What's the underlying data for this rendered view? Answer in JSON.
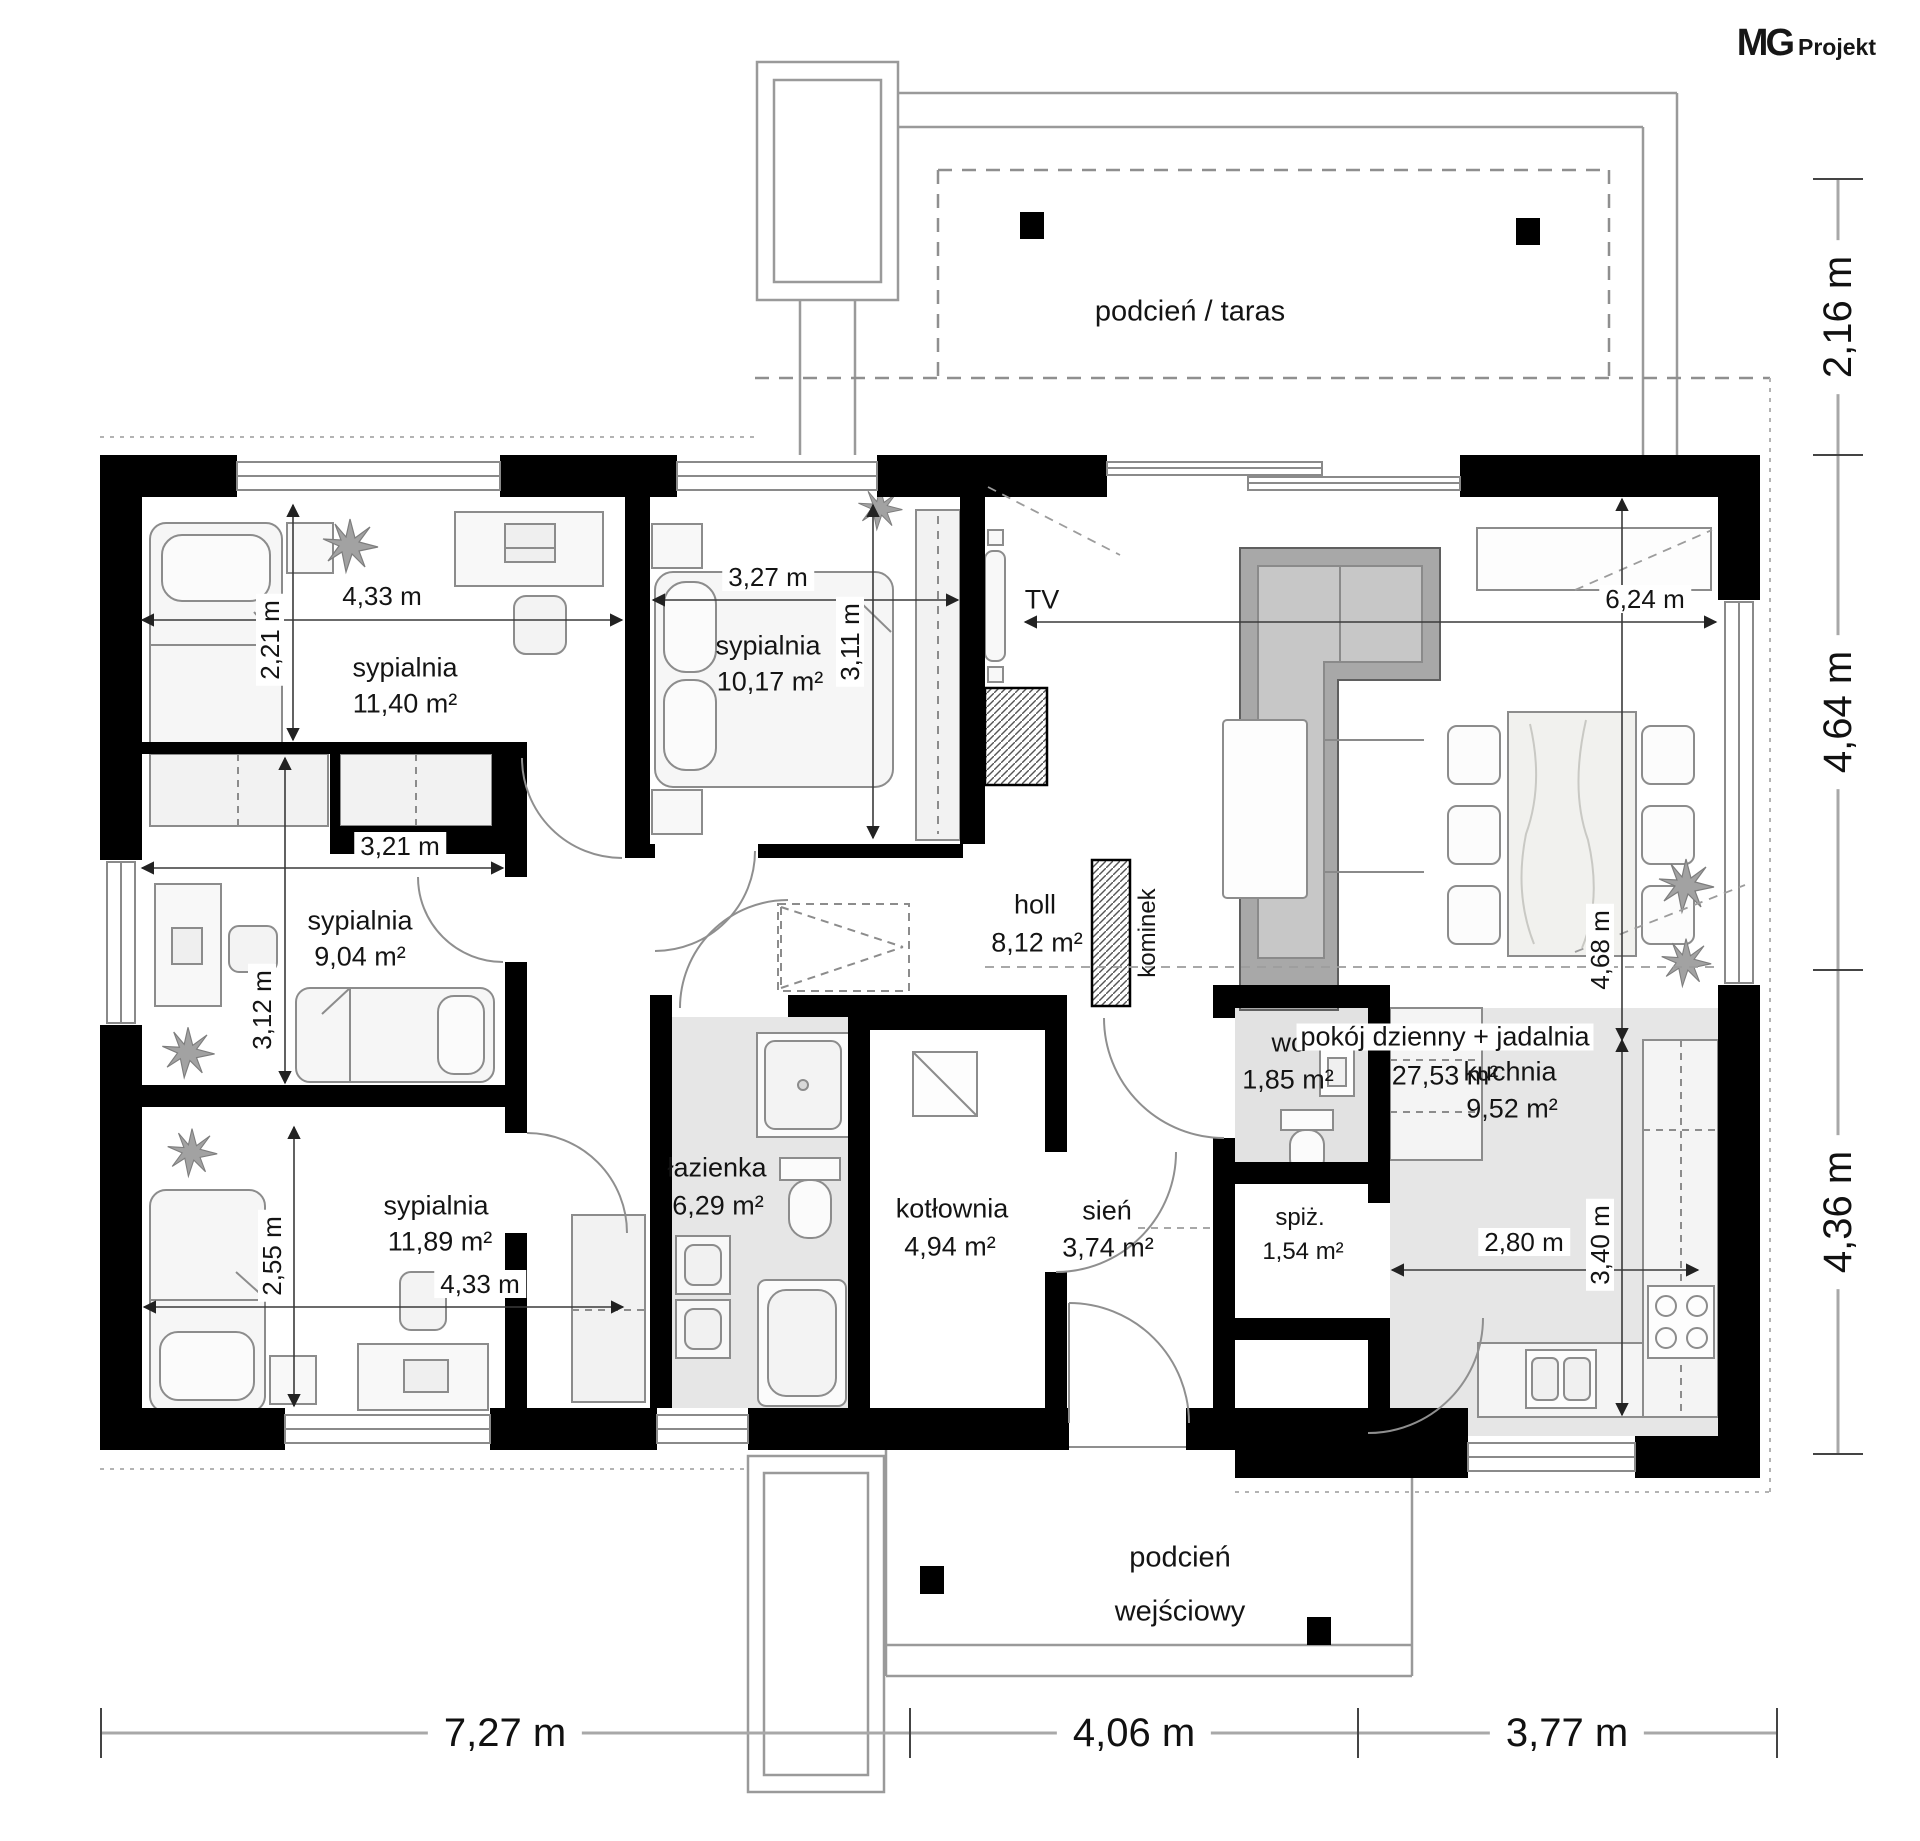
{
  "logo": {
    "brand": "MG",
    "suffix": "Projekt"
  },
  "outdoor": {
    "terrace_label": "podcień / taras",
    "porch_line1": "podcień",
    "porch_line2": "wejściowy"
  },
  "rooms": [
    {
      "name": "sypialnia",
      "area": "11,40 m²"
    },
    {
      "name": "sypialnia",
      "area": "10,17 m²"
    },
    {
      "name": "sypialnia",
      "area": "9,04 m²"
    },
    {
      "name": "sypialnia",
      "area": "11,89 m²"
    },
    {
      "name": "łazienka",
      "area": "6,29 m²"
    },
    {
      "name": "kotłownia",
      "area": "4,94 m²"
    },
    {
      "name": "holl",
      "area": "8,12 m²"
    },
    {
      "name": "wc",
      "area": "1,85 m²"
    },
    {
      "name": "kuchnia",
      "area": "9,52 m²"
    },
    {
      "name": "pokój dzienny + jadalnia",
      "area": "27,53 m²"
    },
    {
      "name": "sień",
      "area": "3,74 m²"
    },
    {
      "name": "spiż.",
      "area": "1,54 m²"
    }
  ],
  "annotations": {
    "tv": "TV",
    "fireplace": "kominek"
  },
  "dimensions": {
    "bed1_w": "4,33 m",
    "bed1_h": "2,21 m",
    "bed2_w": "3,27 m",
    "bed2_h": "3,11 m",
    "bed3_w": "3,21 m",
    "bed3_h": "3,12 m",
    "bed4_w": "4,33 m",
    "bed4_h": "2,55 m",
    "living_w": "6,24 m",
    "living_h": "4,68 m",
    "kitchen_h": "3,40 m",
    "kitchen_w": "2,80 m",
    "overall_bottom": [
      "7,27 m",
      "4,06 m",
      "3,77 m"
    ],
    "overall_right": [
      "2,16 m",
      "4,64 m",
      "4,36 m"
    ]
  },
  "colors": {
    "wall": "#000000",
    "floor_tint": "#e6e6e6",
    "sofa_gray": "#a8a8a8",
    "line_gray": "#8c8c8c",
    "dim_line": "#3a3a3a"
  }
}
